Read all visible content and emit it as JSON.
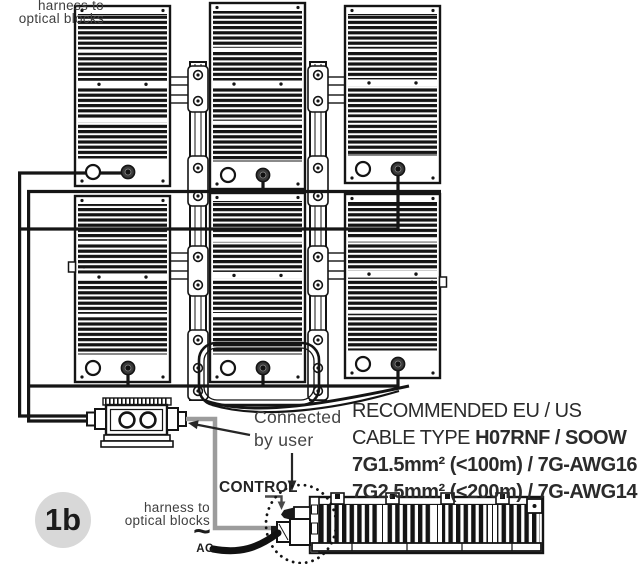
{
  "badge": {
    "label": "1b"
  },
  "labels": {
    "harness_left_1": "harness to",
    "harness_left_2": "optical blocks",
    "connected_1": "Connected",
    "connected_2": "by user",
    "control": "CONTROL",
    "harness_bottom_1": "harness to",
    "harness_bottom_2": "optical blocks",
    "ac_symbol": "~",
    "ac": "AC"
  },
  "cable_note": {
    "line1": "RECOMMENDED EU / US",
    "line2_prefix": "CABLE TYPE ",
    "line2_bold": "H07RNF / SOOW",
    "line3": "7G1.5mm² (<100m) / 7G-AWG16",
    "line4": "7G2.5mm² (<200m) / 7G-AWG14"
  },
  "colors": {
    "line_art": "#141414",
    "label_gray": "#3f3f3f",
    "harness_cable": "#9c9c9c",
    "badge_bg": "#d8d8d8",
    "note_text": "#2b2b2b"
  }
}
